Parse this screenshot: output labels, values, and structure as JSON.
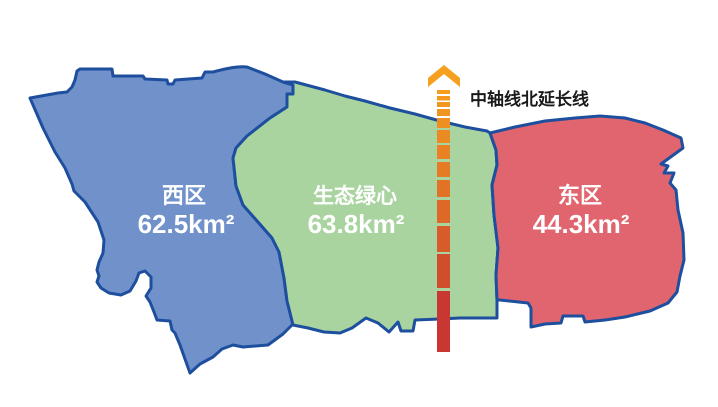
{
  "map": {
    "background": "#FFFFFF",
    "outline_color": "#1D4F9E",
    "regions": [
      {
        "name": "西区",
        "area": "62.5km²",
        "fill": "#7191CB"
      },
      {
        "name": "生态绿心",
        "area": "63.8km²",
        "fill": "#A9D4A0"
      },
      {
        "name": "东区",
        "area": "44.3km²",
        "fill": "#E0656E"
      }
    ],
    "axis": {
      "label": "中轴线北延长线",
      "label_color": "#1A1A1A",
      "color_top": "#F5A01E",
      "color_bottom": "#C22A33",
      "x": 437,
      "width": 13,
      "top_y": 85,
      "bottom_y": 352,
      "dashes": [
        {
          "y": 90,
          "h": 4
        },
        {
          "y": 96,
          "h": 4.5
        },
        {
          "y": 102,
          "h": 5
        },
        {
          "y": 109,
          "h": 7
        },
        {
          "y": 118,
          "h": 10
        },
        {
          "y": 130,
          "h": 13
        },
        {
          "y": 145,
          "h": 14
        },
        {
          "y": 162,
          "h": 15
        },
        {
          "y": 180,
          "h": 17
        },
        {
          "y": 200,
          "h": 23
        },
        {
          "y": 226,
          "h": 26
        },
        {
          "y": 254,
          "h": 34
        },
        {
          "y": 291,
          "h": 61
        }
      ]
    }
  }
}
